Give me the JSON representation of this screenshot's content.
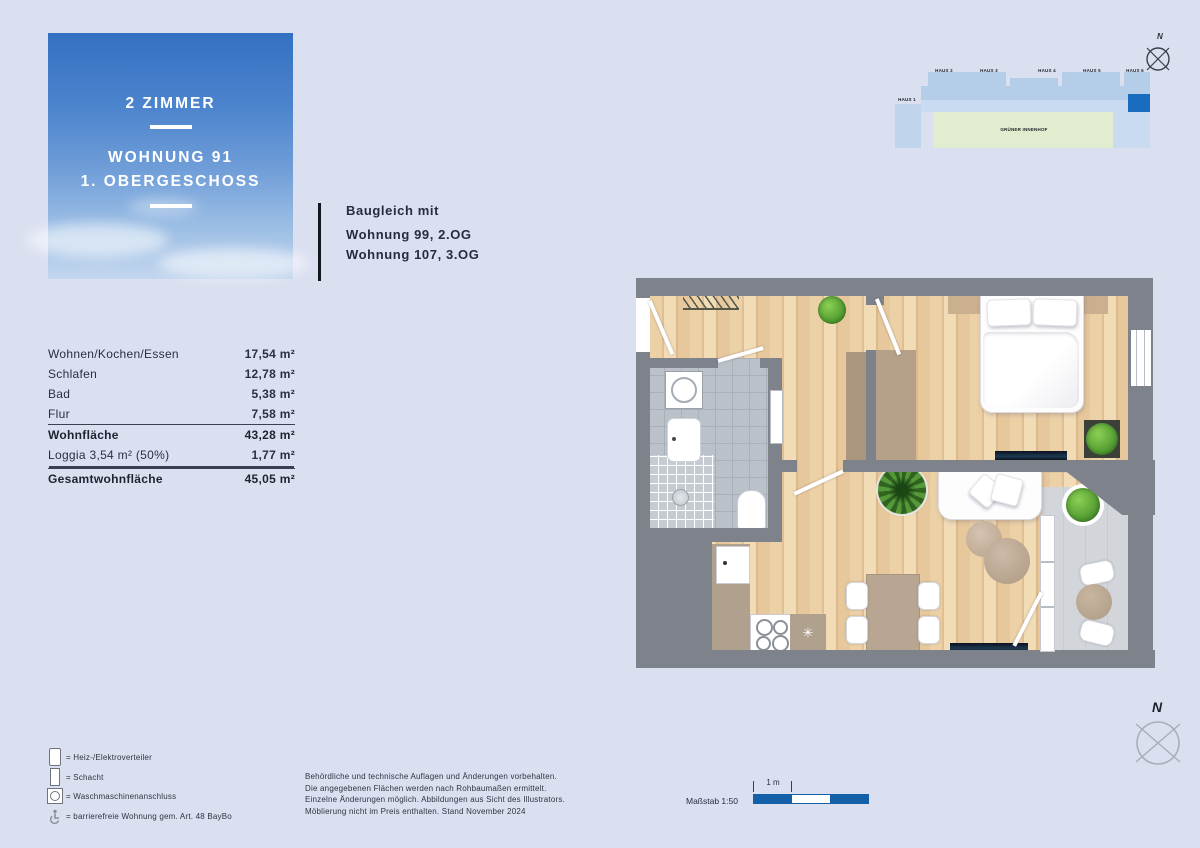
{
  "title_card": {
    "line1": "2 ZIMMER",
    "line2": "WOHNUNG 91",
    "line3": "1. OBERGESCHOSS"
  },
  "baugleich": {
    "heading": "Baugleich mit",
    "items": [
      "Wohnung 99, 2.OG",
      "Wohnung 107, 3.OG"
    ]
  },
  "area_table": {
    "rows": [
      {
        "label": "Wohnen/Kochen/Essen",
        "value": "17,54 m²",
        "bold": false,
        "rule": "none"
      },
      {
        "label": "Schlafen",
        "value": "12,78 m²",
        "bold": false,
        "rule": "none"
      },
      {
        "label": "Bad",
        "value": "5,38 m²",
        "bold": false,
        "rule": "none"
      },
      {
        "label": "Flur",
        "value": "7,58 m²",
        "bold": false,
        "rule": "none"
      },
      {
        "label": "Wohnfläche",
        "value": "43,28 m²",
        "bold": true,
        "rule": "single"
      },
      {
        "label": "Loggia 3,54 m² (50%)",
        "value": "1,77 m²",
        "bold": false,
        "rule": "none"
      },
      {
        "label": "Gesamtwohnfläche",
        "value": "45,05 m²",
        "bold": true,
        "rule": "double"
      }
    ]
  },
  "legend": {
    "items": [
      {
        "icon": "distributor-icon",
        "label": "= Heiz-/Elektroverteiler"
      },
      {
        "icon": "shaft-icon",
        "label": "= Schacht"
      },
      {
        "icon": "washing-machine-icon",
        "label": "= Waschmaschinenanschluss"
      },
      {
        "icon": "accessible-icon",
        "label": "= barrierefreie Wohnung gem. Art. 48 BayBo"
      }
    ]
  },
  "disclaimer": {
    "lines": [
      "Behördliche und technische Auflagen und Änderungen vorbehalten.",
      "Die angegebenen Flächen werden nach Rohbaumaßen ermittelt.",
      "Einzelne Änderungen möglich. Abbildungen aus Sicht des Illustrators.",
      "Möblierung nicht im Preis enthalten. Stand November 2024"
    ]
  },
  "scale_bar": {
    "label": "Maßstab 1:50",
    "unit": "1 m"
  },
  "site_plan": {
    "houses": [
      "HAUS 1",
      "HAUS 2",
      "HAUS 3",
      "HAUS 4",
      "HAUS 5",
      "HAUS 6"
    ],
    "courtyard": "GRÜNER INNENHOF"
  },
  "compass": {
    "north": "N"
  },
  "colors": {
    "accent_blue": "#1a6dbe",
    "scale_blue": "#135fa8",
    "wall_gray": "#7d828b"
  }
}
